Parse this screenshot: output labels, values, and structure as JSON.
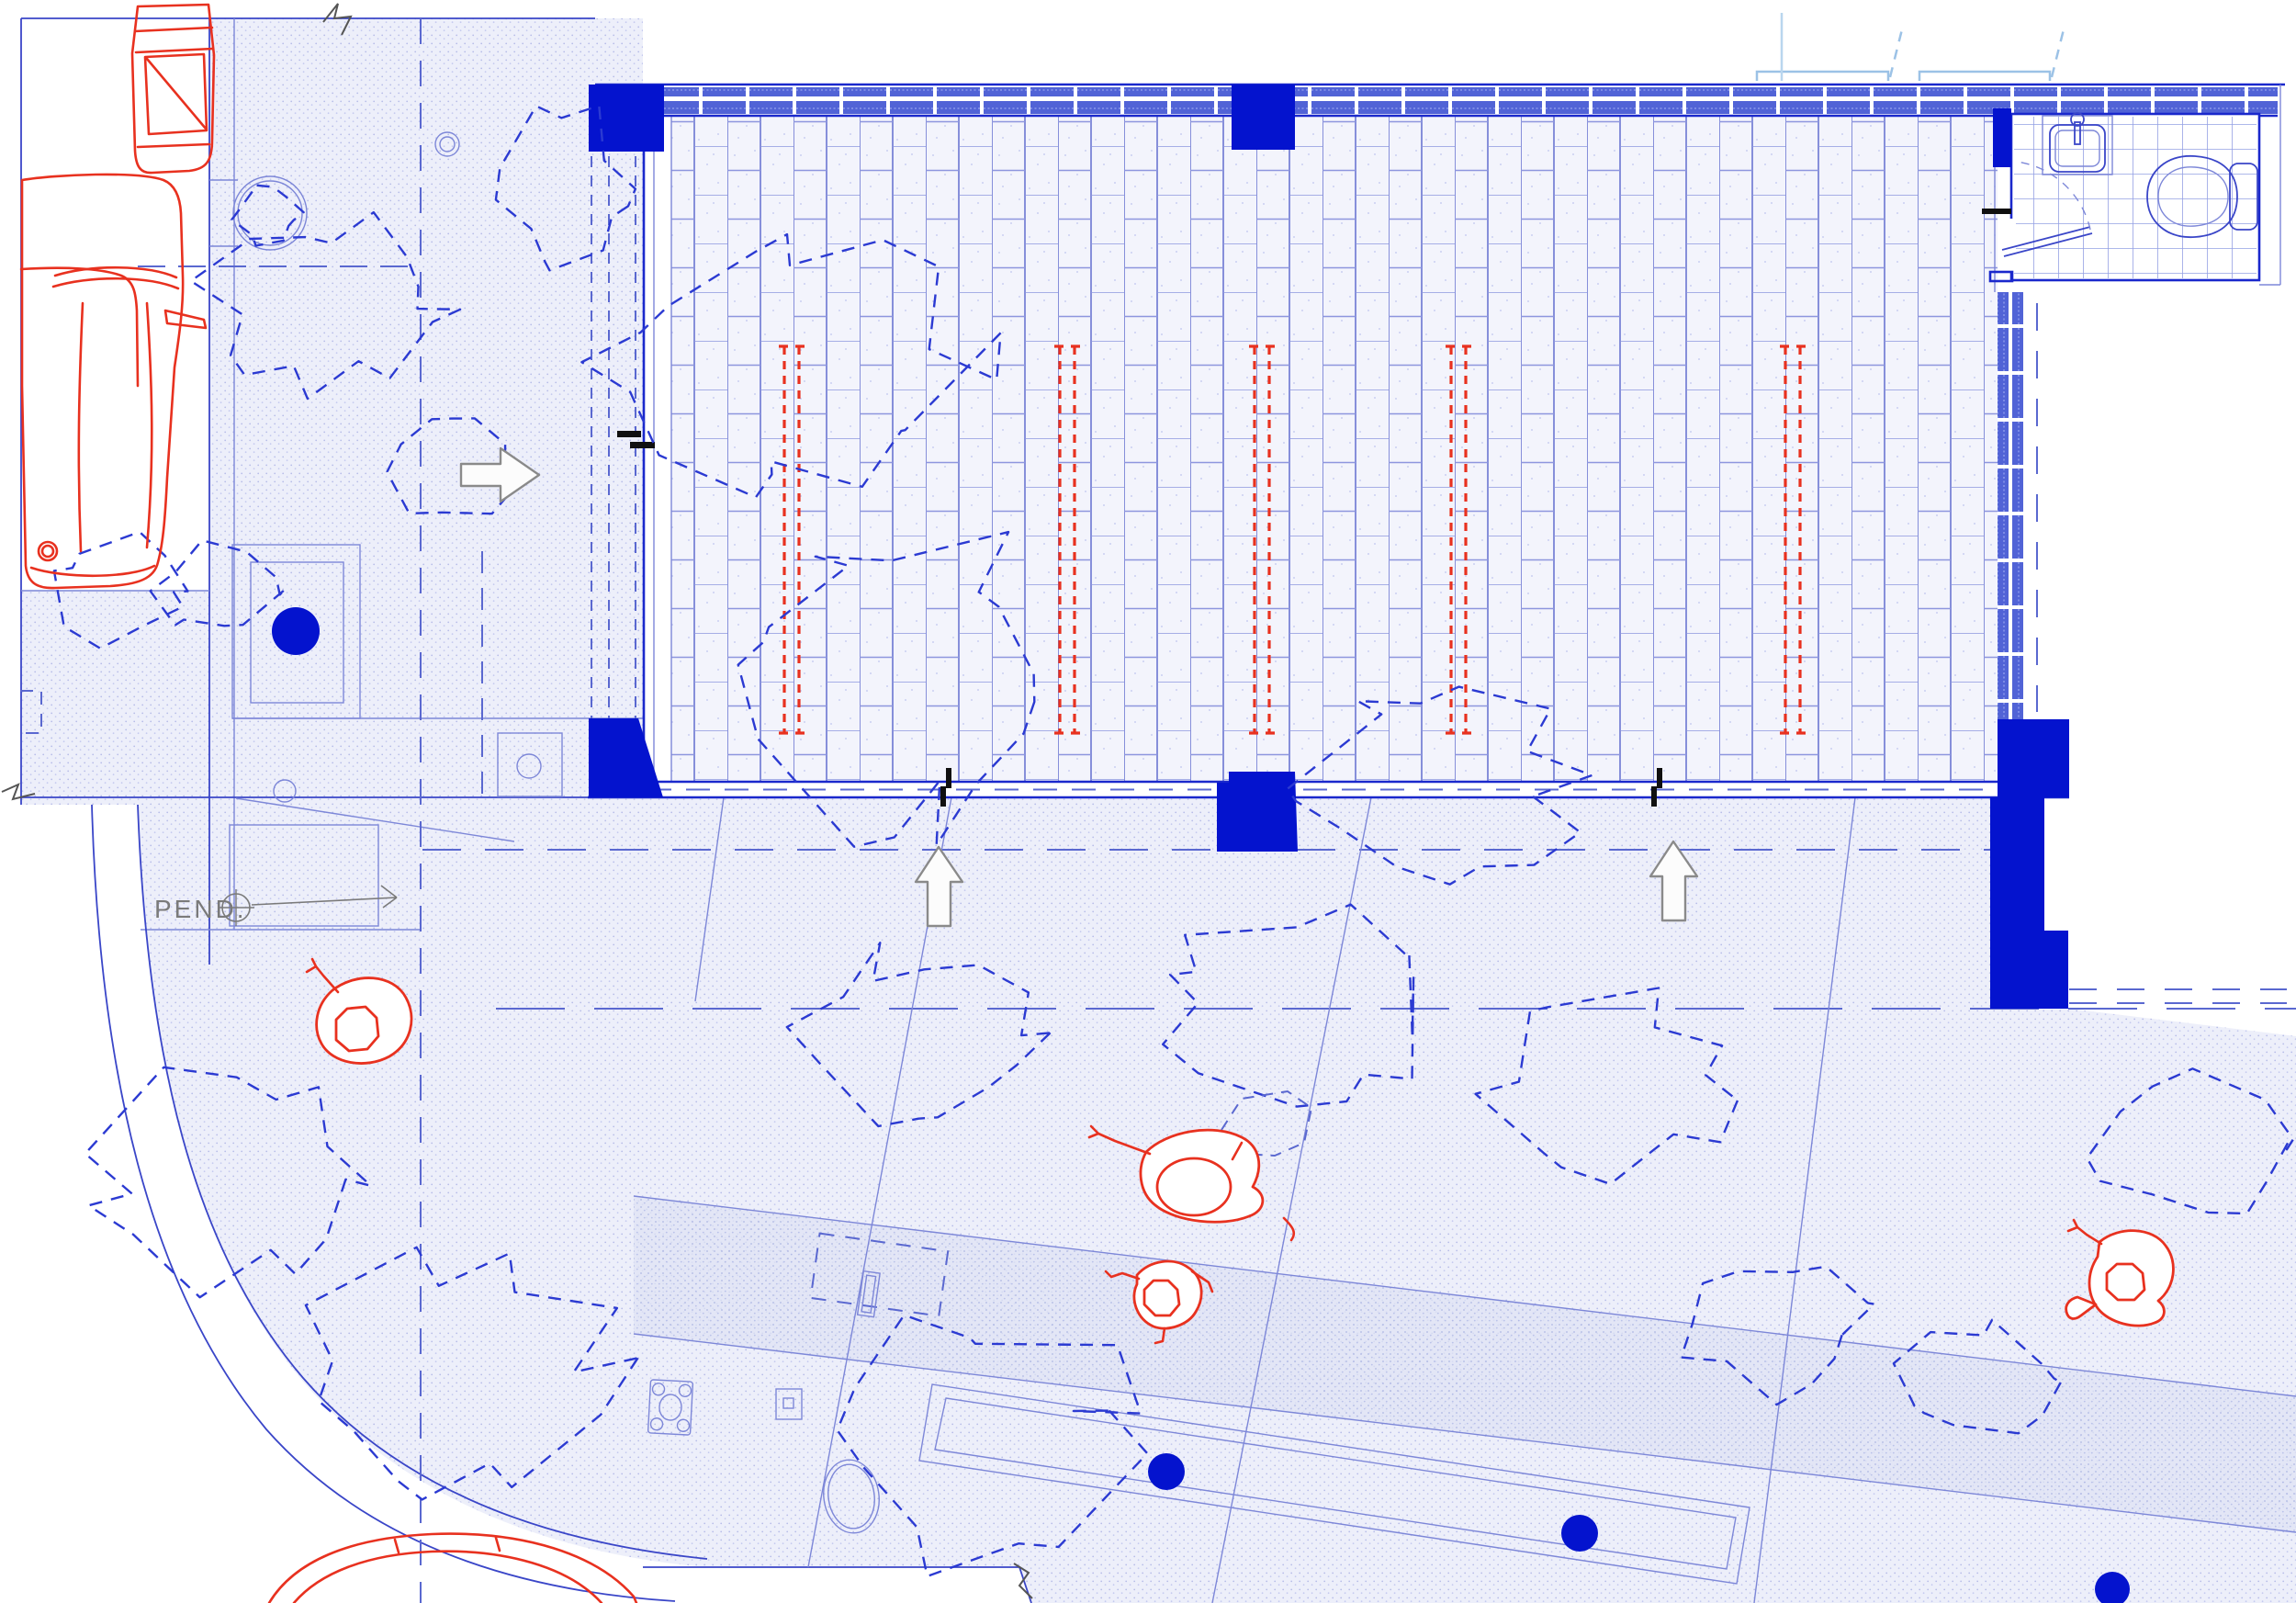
{
  "document": {
    "type": "architectural-site-plan",
    "visible_text": [
      "PEND."
    ]
  },
  "annotations": {
    "pend_label": "PEND."
  },
  "palette": {
    "line_blue": "#2b3ad2",
    "wall_blue": "#1a28cc",
    "solid_column_blue": "#0413ce",
    "tile_band_blue": "#5163d6",
    "hatch_dot_blue": "#b7bde9",
    "marking_red": "#e8311f",
    "annotation_gray": "#7a7a7a",
    "canopy_light_blue": "#9cc2e6",
    "paper_white": "#ffffff"
  },
  "features": {
    "solid_columns": 5,
    "red_heating_strips": 5,
    "people_figures": 4,
    "cars": 3,
    "direction_arrows": [
      "right",
      "up",
      "up"
    ],
    "solid_blue_dots": 4,
    "bathroom_fixtures": [
      "sink",
      "toilet",
      "door"
    ],
    "tree_canopies": 18
  }
}
